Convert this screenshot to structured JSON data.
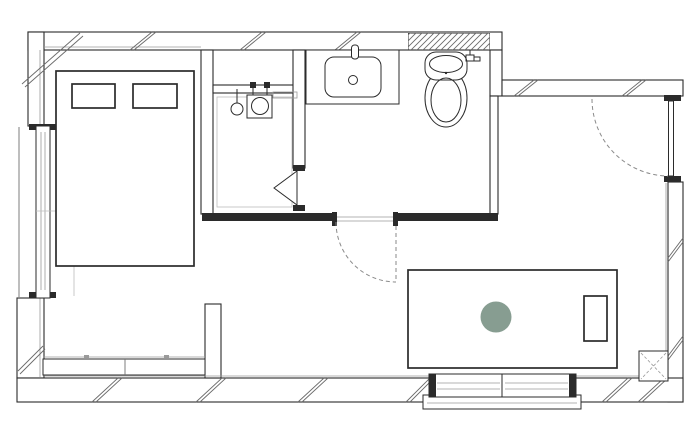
{
  "colors": {
    "background": "#ffffff",
    "line": "#2b2b2b",
    "line_medium": "#6f6f6f",
    "line_light": "#9a9a9a",
    "line_faint": "#bdbdbd",
    "hatch": "#6a6a6a",
    "dash": "#8a8a8a",
    "accent_green": "#879d91",
    "wall_fill": "#ffffff"
  },
  "floorplan": {
    "canvas": {
      "width": 700,
      "height": 436
    },
    "drawing_type": "architectural floor plan, black line work on white, no text labels",
    "elements": [
      {
        "name": "bed",
        "kind": "furniture",
        "note": "double bed with two pillows, upper left room"
      },
      {
        "name": "pillow-left",
        "kind": "furniture"
      },
      {
        "name": "pillow-right",
        "kind": "furniture"
      },
      {
        "name": "left-window",
        "kind": "opening",
        "note": "tall sliding window in left wall"
      },
      {
        "name": "storage-bench",
        "kind": "furniture",
        "note": "low two-section bench along bottom-left wall"
      },
      {
        "name": "partition-stub-wall",
        "kind": "wall"
      },
      {
        "name": "table",
        "kind": "furniture",
        "note": "large rectangular table in living area"
      },
      {
        "name": "chair",
        "kind": "furniture",
        "note": "small rectangle on right side of table"
      },
      {
        "name": "round-stool",
        "kind": "furniture",
        "note": "sage green filled circle on table",
        "color": "#879d91"
      },
      {
        "name": "sliding-window-bottom",
        "kind": "opening",
        "note": "two-panel sliding glass door in bottom wall"
      },
      {
        "name": "column",
        "kind": "structure",
        "note": "square column with dashed X, bottom right"
      },
      {
        "name": "entry-door",
        "kind": "door",
        "note": "right wall, dashed quarter-circle swing into room"
      },
      {
        "name": "bathroom-door",
        "kind": "door",
        "note": "dashed quarter-circle swing from bathroom into living area"
      },
      {
        "name": "shower-door",
        "kind": "door",
        "note": "triangle door symbol into shower room"
      },
      {
        "name": "shower-head",
        "kind": "fixture"
      },
      {
        "name": "shower-mixer-unit",
        "kind": "fixture"
      },
      {
        "name": "shower-valves",
        "kind": "fixture"
      },
      {
        "name": "shower-shelf",
        "kind": "fixture"
      },
      {
        "name": "vanity-counter",
        "kind": "fixture"
      },
      {
        "name": "wash-basin",
        "kind": "fixture"
      },
      {
        "name": "basin-faucet",
        "kind": "fixture"
      },
      {
        "name": "basin-drain",
        "kind": "fixture"
      },
      {
        "name": "toilet",
        "kind": "fixture",
        "note": "tankless toilet below hatched wall segment"
      },
      {
        "name": "toilet-valve",
        "kind": "fixture"
      },
      {
        "name": "insulation-hatch-marks",
        "kind": "annotation",
        "note": "paired diagonal slashes in outer walls"
      },
      {
        "name": "hatched-wall-segment",
        "kind": "wall",
        "note": "densely hatched wall above toilet"
      }
    ]
  }
}
